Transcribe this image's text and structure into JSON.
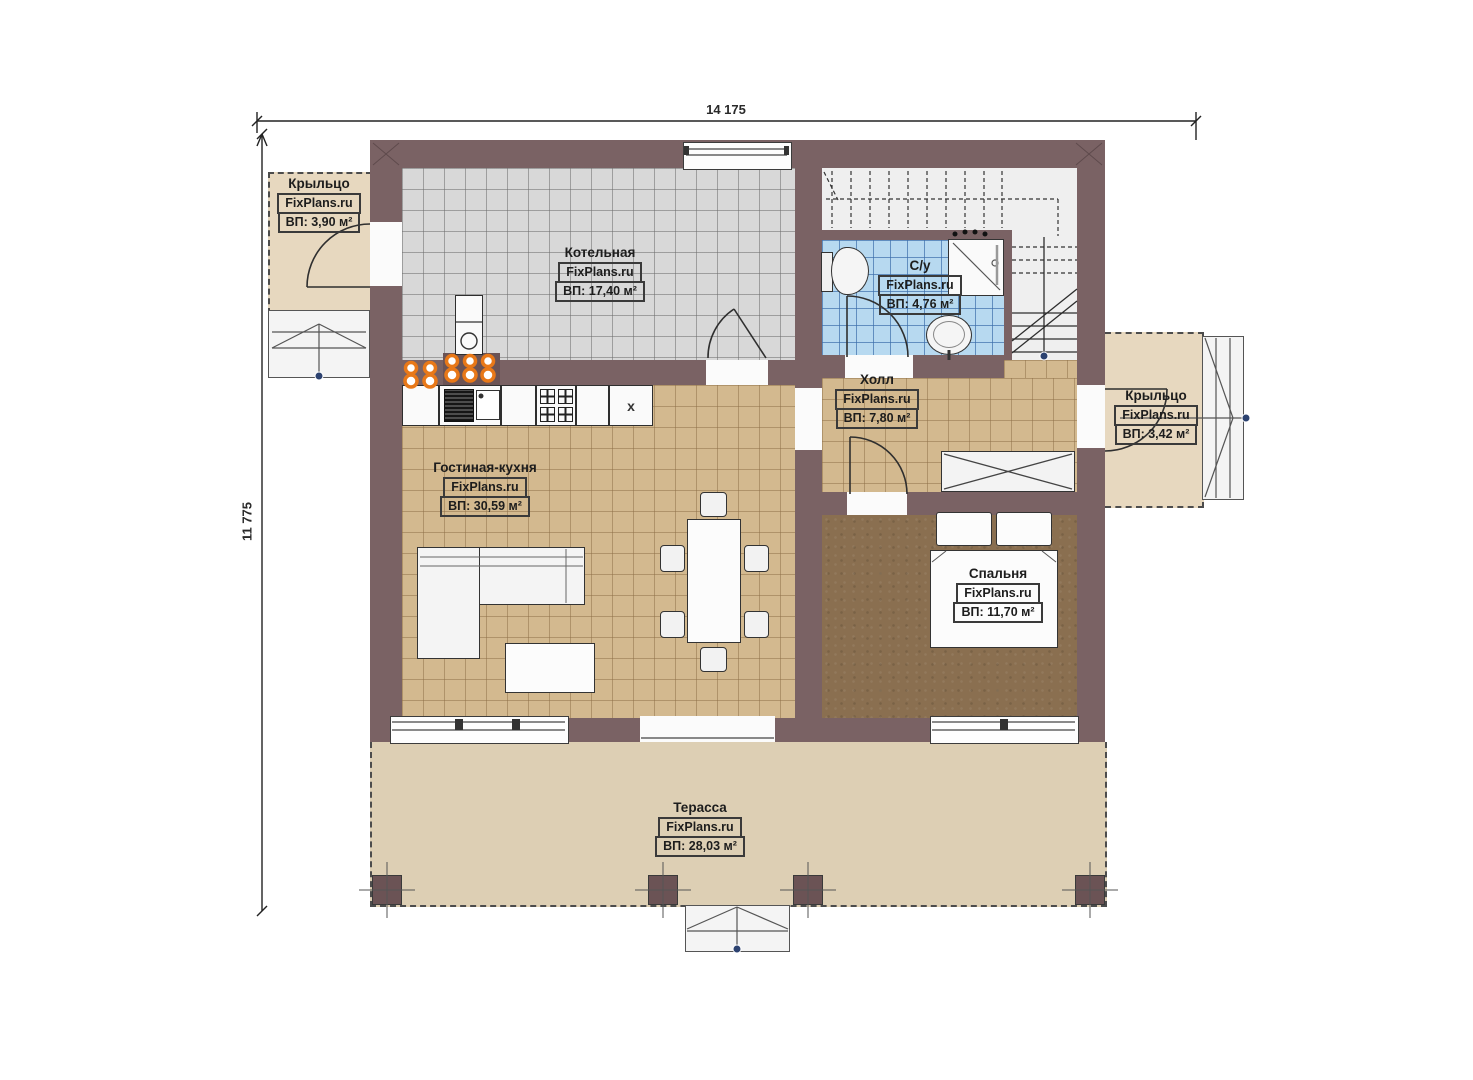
{
  "plan": {
    "watermark": "FixPlans.ru",
    "dimensions": {
      "width_label": "14 175",
      "height_label": "11 775"
    },
    "rooms": [
      {
        "id": "porch-left",
        "name": "Крыльцо",
        "area": "ВП: 3,90 м²"
      },
      {
        "id": "boiler-room",
        "name": "Котельная",
        "area": "ВП: 17,40 м²"
      },
      {
        "id": "bathroom",
        "name": "С/у",
        "area": "ВП: 4,76 м²"
      },
      {
        "id": "hall",
        "name": "Холл",
        "area": "ВП: 7,80 м²"
      },
      {
        "id": "porch-right",
        "name": "Крыльцо",
        "area": "ВП: 3,42 м²"
      },
      {
        "id": "living-kitchen",
        "name": "Гостиная-кухня",
        "area": "ВП: 30,59 м²"
      },
      {
        "id": "bedroom",
        "name": "Спальня",
        "area": "ВП: 11,70 м²"
      },
      {
        "id": "terrace",
        "name": "Терасса",
        "area": "ВП: 28,03 м²"
      }
    ],
    "symbols": {
      "cabinet_cross": "x"
    },
    "colors": {
      "wall": "#7a6264",
      "boiler_floor": "#d8d8d8",
      "bath_floor": "#b7d9f0",
      "tan_floor": "#d3b98f",
      "bedroom_floor": "#8a6f50",
      "terrace": "#ddcfb4",
      "porch": "#e7d8bf",
      "radiator": "#e87818",
      "marker_dot": "#2c4270"
    }
  }
}
